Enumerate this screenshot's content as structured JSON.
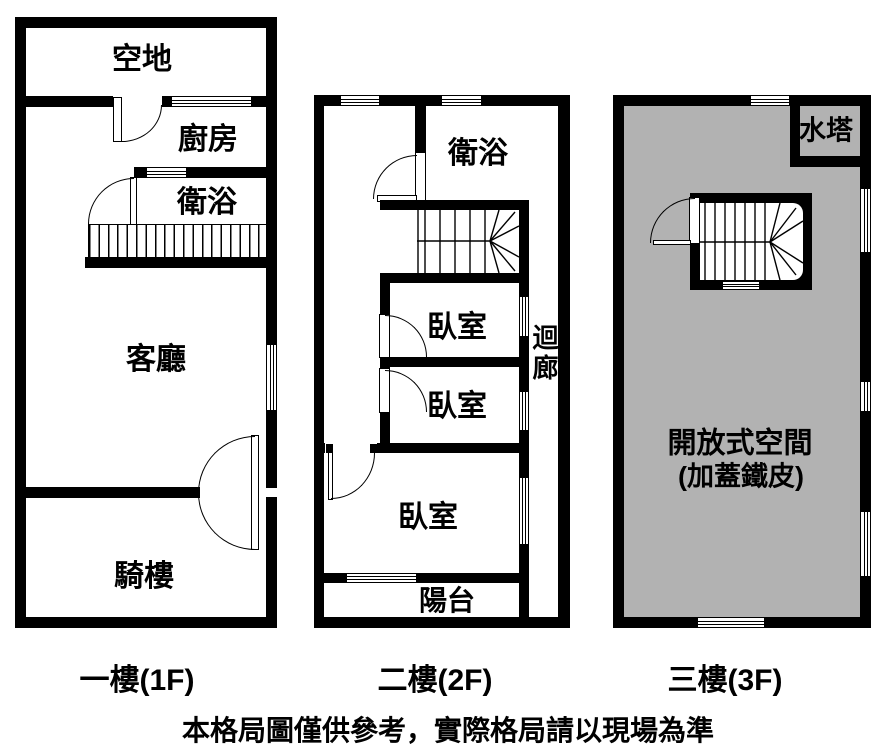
{
  "colors": {
    "wall": "#000000",
    "background": "#ffffff",
    "open_space_fill": "#b2b2b2"
  },
  "floors": [
    {
      "caption": "一樓(1F)",
      "rooms": [
        {
          "label": "空地"
        },
        {
          "label": "廚房"
        },
        {
          "label": "衛浴"
        },
        {
          "label": "客廳"
        },
        {
          "label": "騎樓"
        }
      ]
    },
    {
      "caption": "二樓(2F)",
      "rooms": [
        {
          "label": "衛浴"
        },
        {
          "label": "臥室"
        },
        {
          "label": "臥室"
        },
        {
          "label": "臥室"
        },
        {
          "label": "迴廊"
        },
        {
          "label": "陽台"
        }
      ]
    },
    {
      "caption": "三樓(3F)",
      "rooms": [
        {
          "label": "水塔"
        },
        {
          "label": "開放式空間",
          "sublabel": "(加蓋鐵皮)"
        }
      ]
    }
  ],
  "disclaimer": "本格局圖僅供參考，實際格局請以現場為準"
}
